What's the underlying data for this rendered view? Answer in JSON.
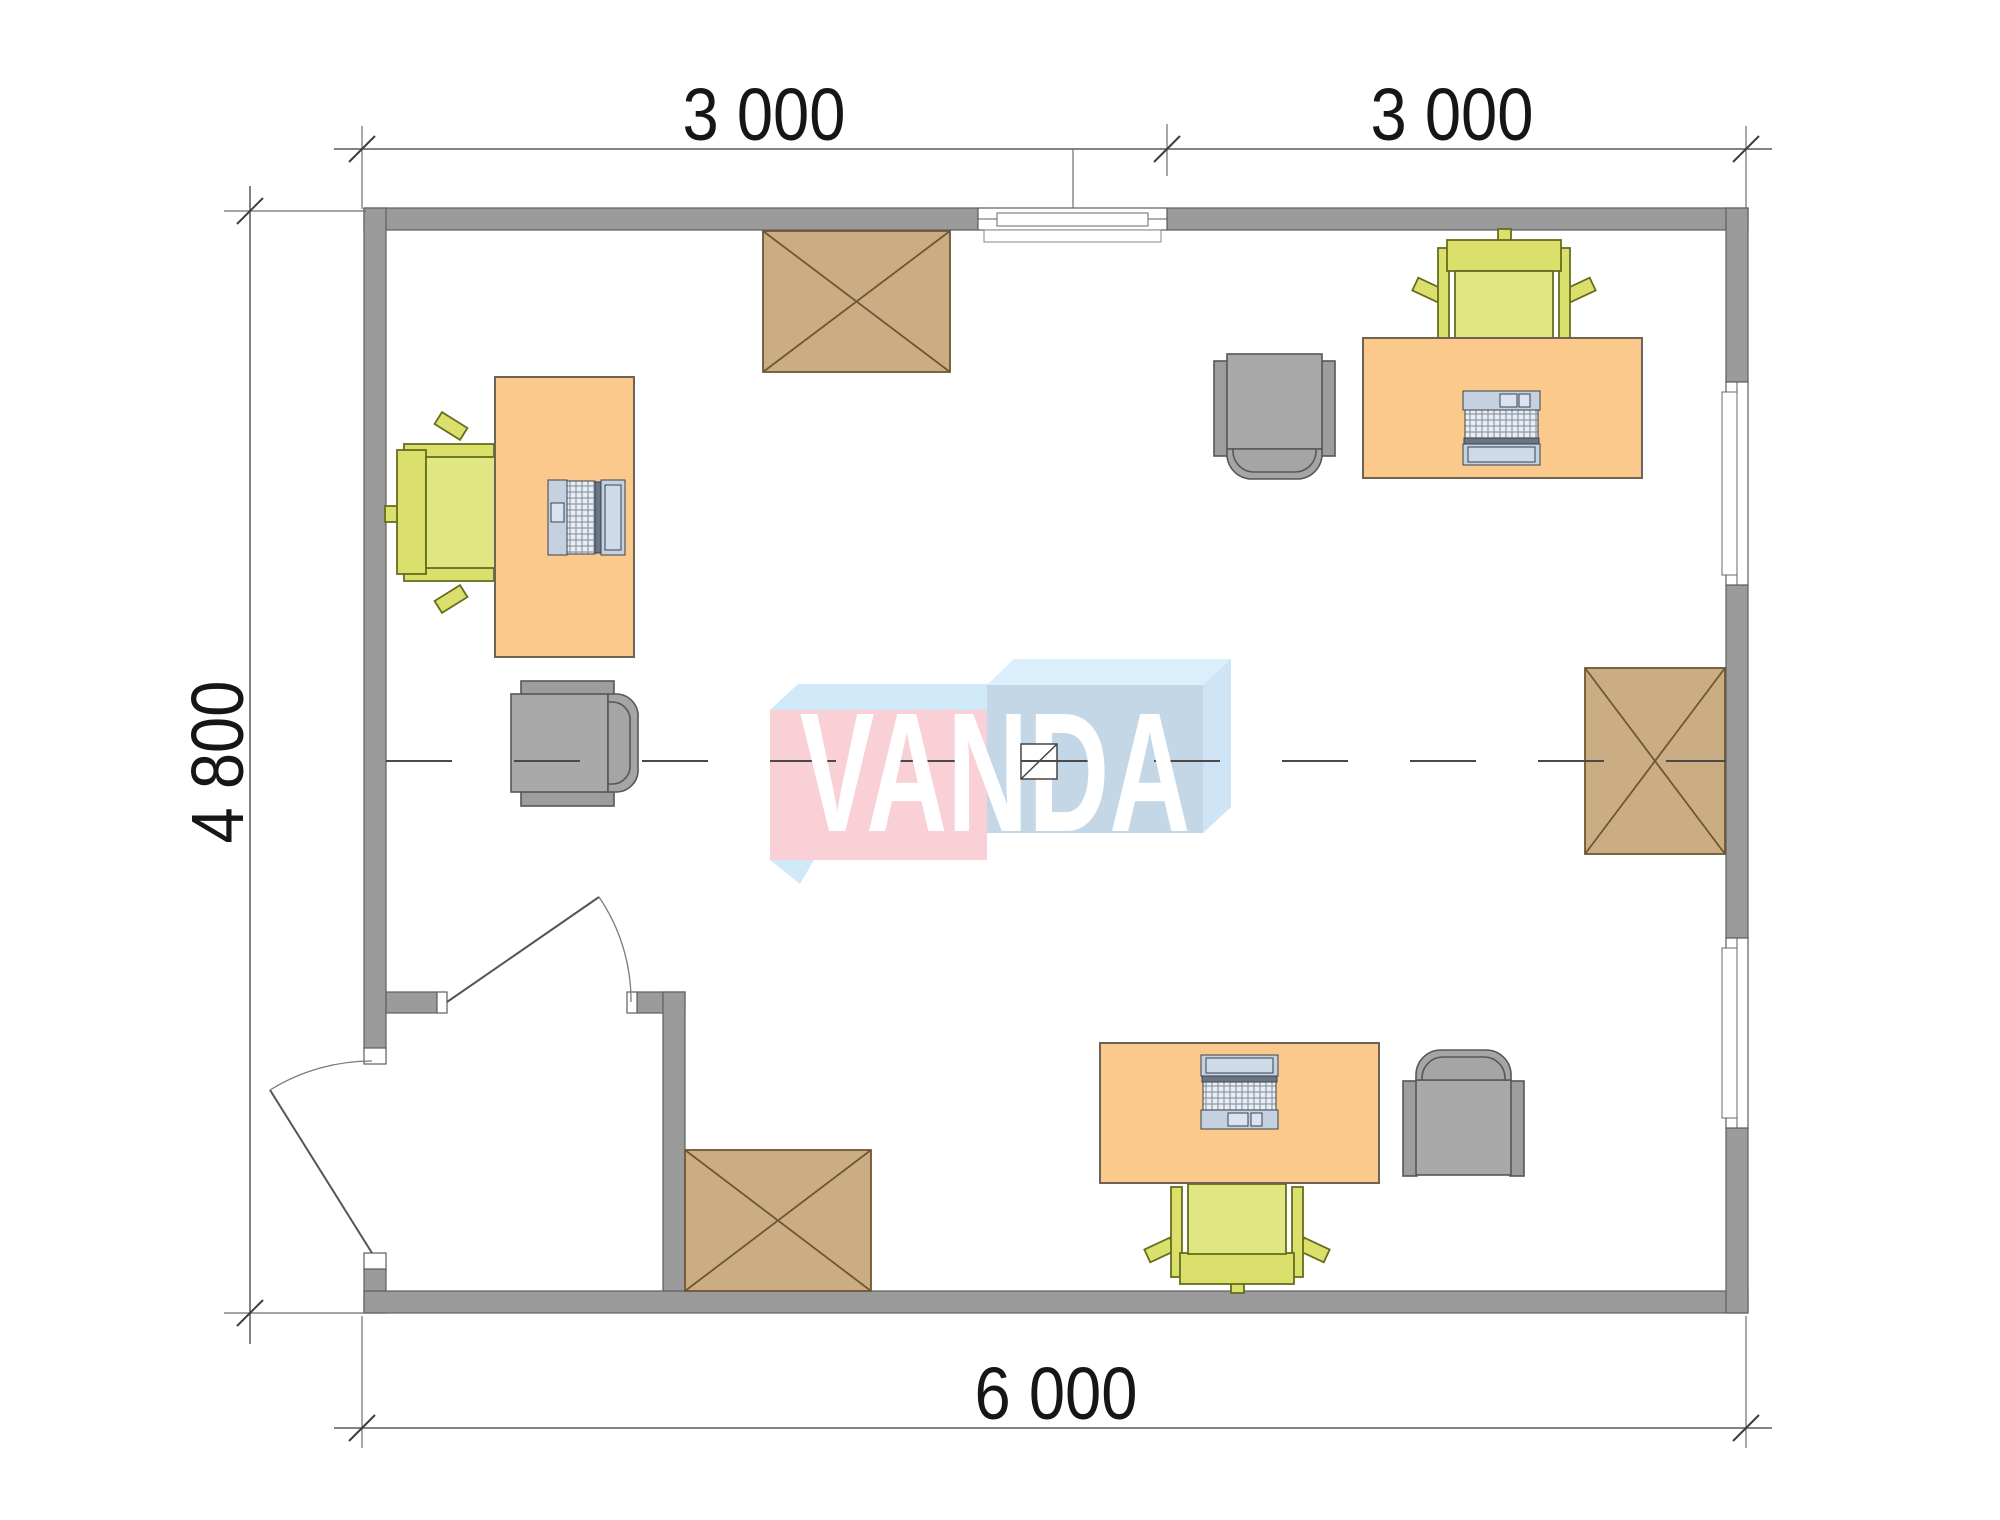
{
  "drawing": {
    "type": "floor-plan",
    "watermark_logo": "VANDA",
    "dimensions": {
      "top_left": "3 000",
      "top_right": "3 000",
      "left": "4 800",
      "bottom": "6 000"
    },
    "furniture": {
      "desks": 3,
      "laptops": 3,
      "green_chairs": 3,
      "gray_armchairs": 3,
      "crossed_tables": 3
    },
    "openings": {
      "windows": 3,
      "doors": 2
    },
    "colors": {
      "wall": "#9b9b9b",
      "wall_outline": "#5e5e5e",
      "desk": "#fcc98c",
      "desk_outline": "#6e6354",
      "table": "#cbad84",
      "table_outline": "#715634",
      "chair_green": "#dbe06c",
      "chair_green_seat": "#e0e681",
      "chair_green_outline": "#666d1d",
      "chair_gray": "#a9a9a9",
      "chair_gray_outline": "#565656",
      "laptop_body": "#c5d1e0",
      "dimension_line": "#5a5a5a",
      "axis_line": "#4a4a4a",
      "logo_pink": "#f8d0d5",
      "logo_blue_top": "#cfe9f8",
      "logo_blue_face": "#c3d7e7",
      "logo_blue_top2": "#daeefb",
      "logo_blue_side": "#cfe4f4",
      "logo_text": "#ffffff"
    }
  }
}
